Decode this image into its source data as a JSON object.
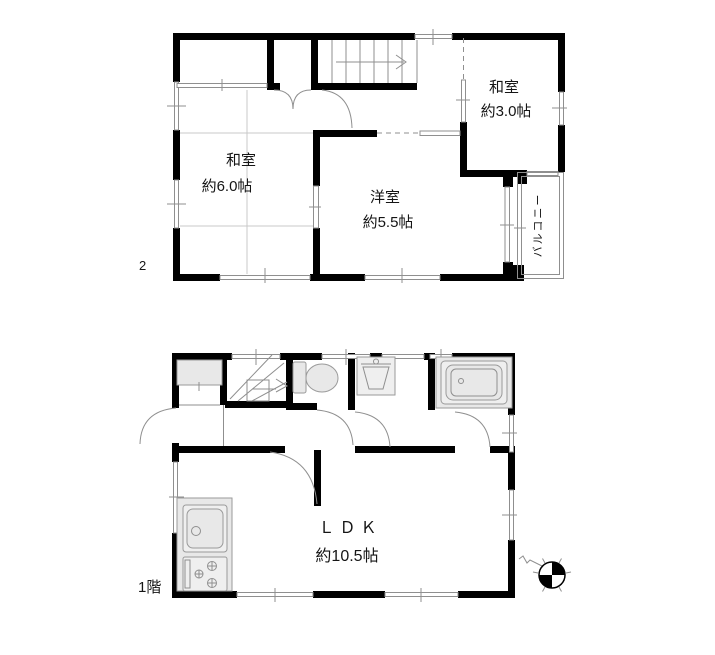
{
  "floors": {
    "second": {
      "label": "2",
      "washitsu6": {
        "name": "和室",
        "area": "約6.0帖"
      },
      "yoshitsu": {
        "name": "洋室",
        "area": "約5.5帖"
      },
      "washitsu3": {
        "name": "和室",
        "area": "約3.0帖"
      },
      "balcony": "バルコニー"
    },
    "first": {
      "label": "1階",
      "ldk": {
        "name": "ＬＤＫ",
        "area": "約10.5帖"
      }
    }
  },
  "colors": {
    "wall": "#000000",
    "thin_line": "#8f8f8f",
    "fixture_fill": "#e8e8e8",
    "background": "#ffffff"
  }
}
